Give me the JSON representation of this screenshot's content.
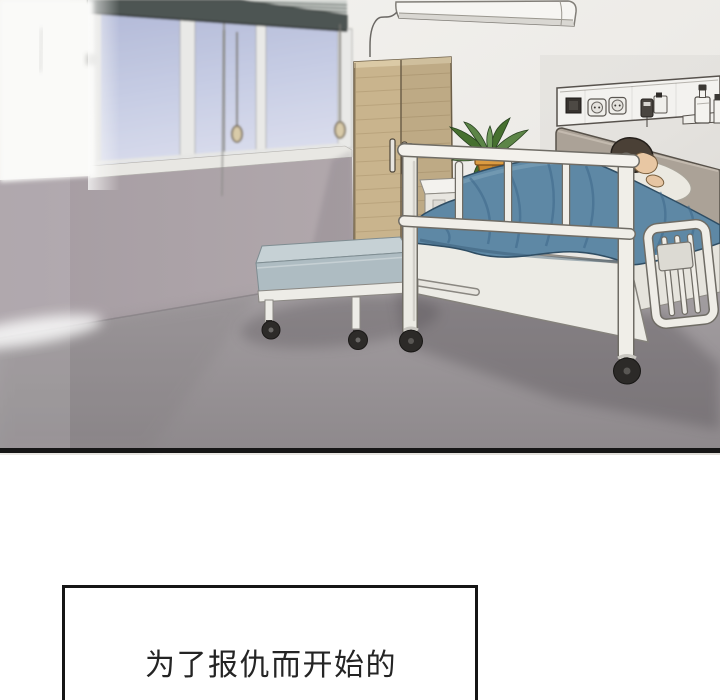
{
  "caption": {
    "text": "为了报仇而开始的"
  },
  "panel": {
    "kind": "webtoon-comic-panel",
    "scene_description": "hospital room with patient in bed",
    "objects": [
      "window-with-blinds",
      "blind-valance",
      "blind-slats",
      "blind-pull-cords",
      "air-conditioner",
      "wardrobe",
      "bed-head-unit-panel",
      "power-outlets",
      "medicine-bottles",
      "wooden-headboard",
      "pillow",
      "patient-head",
      "blue-blanket",
      "hospital-bed-foot-rail",
      "bed-base",
      "lowered-side-rail",
      "caster-wheels",
      "caregiver-cot",
      "nightstand",
      "potted-plant",
      "floor",
      "panel-bottom-border"
    ],
    "colors": {
      "blanket": "#5e88a5",
      "floor": "#9b9598",
      "upper_wall": "#ece9e5",
      "lower_wall": "#a9a0a6",
      "wardrobe_wood": "#c9b48d",
      "window_glass": "#c3c9e2",
      "valance": "#4d5552",
      "cot_mattress": "#c6d1d5",
      "bed_frame": "#f0eee8",
      "plant_pot": "#c9882f",
      "plant_leaves": "#5c8547",
      "patient_hair": "#4a4036",
      "patient_skin": "#e8c7a3",
      "border": "#161616"
    }
  }
}
